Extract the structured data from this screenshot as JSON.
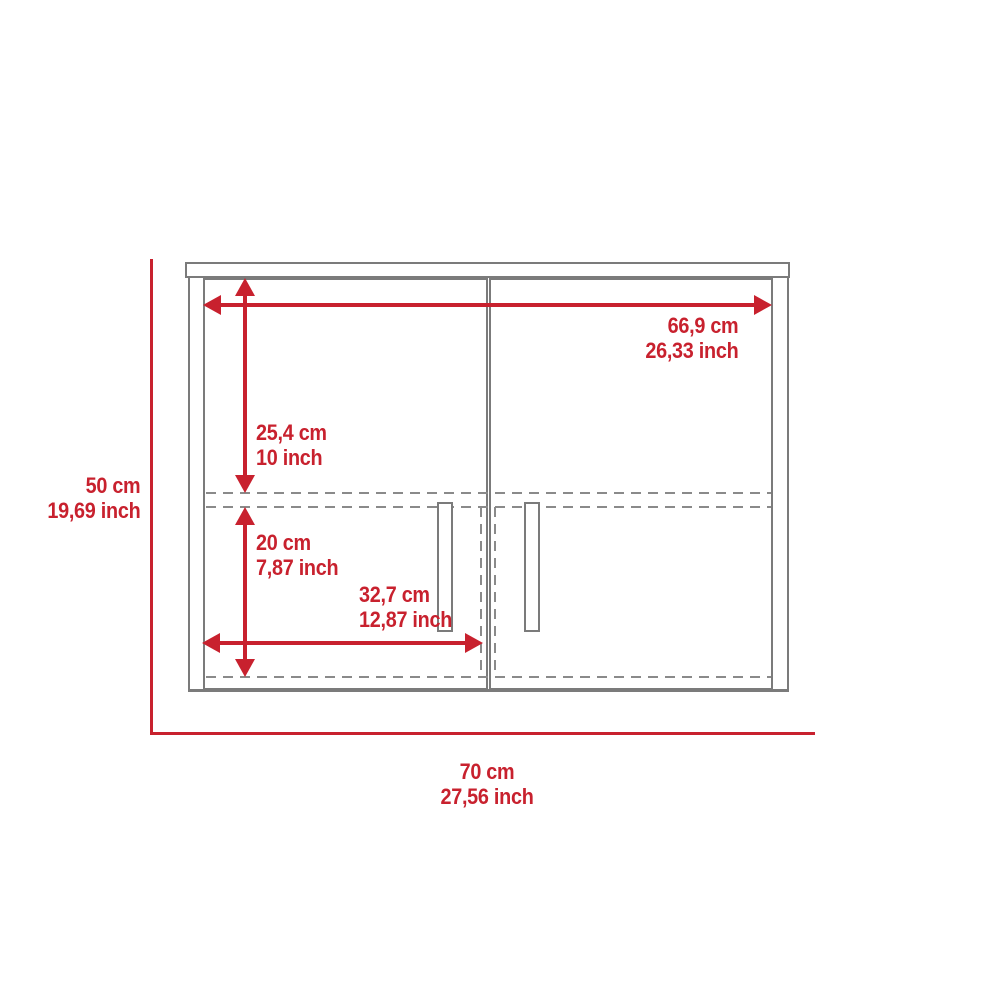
{
  "diagram": {
    "subject": "wall-cabinet-two-doors-front-dimension-drawing",
    "dimensions": {
      "inner_width": {
        "cm": "66,9 cm",
        "inch": "26,33 inch"
      },
      "upper_section_height": {
        "cm": "25,4 cm",
        "inch": "10 inch"
      },
      "lower_section_height": {
        "cm": "20 cm",
        "inch": "7,87 inch"
      },
      "door_width": {
        "cm": "32,7 cm",
        "inch": "12,87 inch"
      },
      "overall_height": {
        "cm": "50 cm",
        "inch": "19,69 inch"
      },
      "overall_width": {
        "cm": "70 cm",
        "inch": "27,56 inch"
      }
    }
  },
  "colors": {
    "dimension_red": "#C8212E",
    "outline_gray": "#7b7b7b",
    "seam_gray": "#696969",
    "dashed_gray": "#8a8a8a"
  }
}
